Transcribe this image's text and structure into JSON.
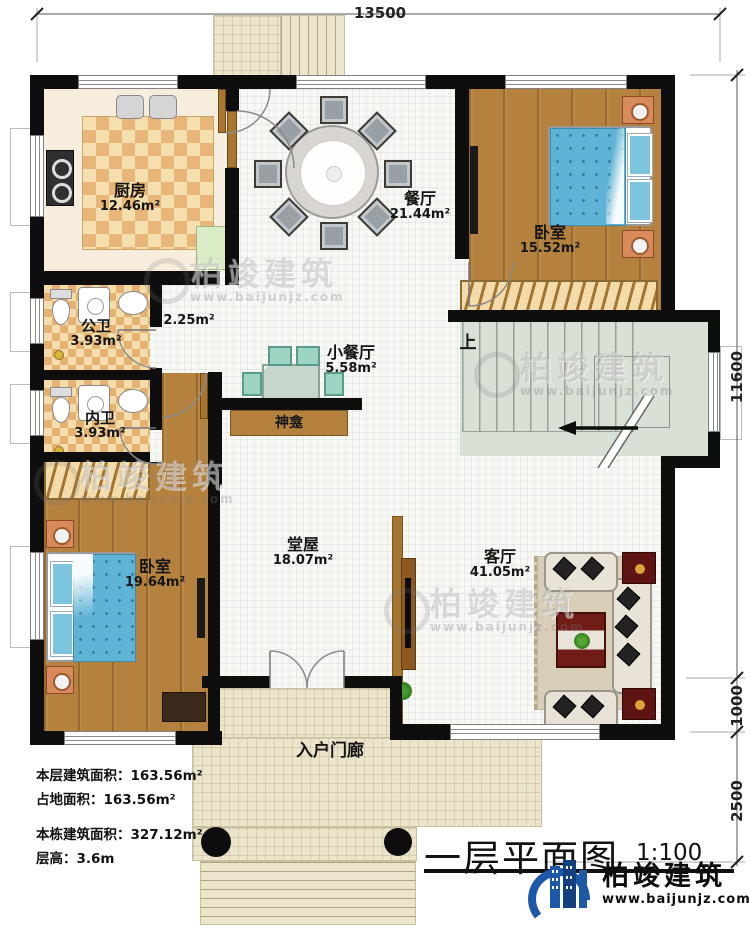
{
  "title": {
    "text": "一层平面图",
    "scale": "1:100"
  },
  "brand": {
    "name": "柏竣建筑",
    "url": "www.baijunjz.com"
  },
  "watermark": {
    "name": "柏竣建筑",
    "url": "www.baijunjz.com"
  },
  "dims": {
    "top": "13500",
    "right_total": "11600",
    "right_mid": "1000",
    "right_porch": "2500"
  },
  "stats": {
    "line1": "本层建筑面积：163.56m²",
    "line2": "占地面积：163.56m²",
    "line3": "本栋建筑面积：327.12m²",
    "line4": "层高：3.6m"
  },
  "stair": {
    "up": "上"
  },
  "rooms": {
    "kitchen": {
      "name": "厨房",
      "area": "12.46m²"
    },
    "dining": {
      "name": "餐厅",
      "area": "21.44m²"
    },
    "bedroom_top": {
      "name": "卧室",
      "area": "15.52m²"
    },
    "public_bath": {
      "name": "公卫",
      "area": "3.93m²"
    },
    "corridor": {
      "area": "2.25m²"
    },
    "private_bath": {
      "name": "内卫",
      "area": "3.93m²"
    },
    "small_dining": {
      "name": "小餐厅",
      "area": "5.58m²"
    },
    "shrine": {
      "name": "神龛"
    },
    "hall": {
      "name": "堂屋",
      "area": "18.07m²"
    },
    "bedroom_bottom": {
      "name": "卧室",
      "area": "19.64m²"
    },
    "living": {
      "name": "客厅",
      "area": "41.05m²"
    },
    "porch": {
      "name": "入户门廊"
    }
  },
  "colors": {
    "wall": "#0e0e0e",
    "brand_blue": "#1c57a8",
    "mattress": "#5fb3d4",
    "stair": "#d9e0d6"
  }
}
